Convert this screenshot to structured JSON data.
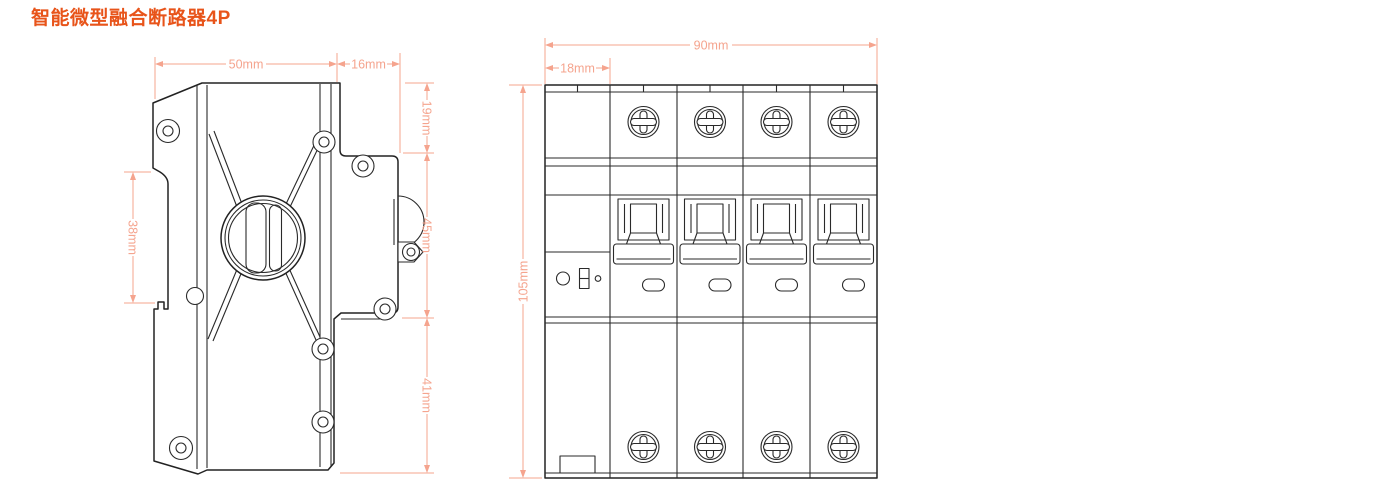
{
  "title": {
    "text": "智能微型融合断路器4P"
  },
  "colors": {
    "accent": "#e8541a",
    "dimension": "#f5a48e",
    "drawing_line": "#222222",
    "background": "#ffffff"
  },
  "side_view": {
    "dims": {
      "top_width": "50mm",
      "ext_width": "16mm",
      "upper_height": "19mm",
      "middle_height": "45mm",
      "lower_height": "41mm",
      "rail_slot_height": "38mm"
    }
  },
  "front_view": {
    "dims": {
      "total_width": "90mm",
      "pole_width": "18mm",
      "total_height": "105mm"
    }
  }
}
